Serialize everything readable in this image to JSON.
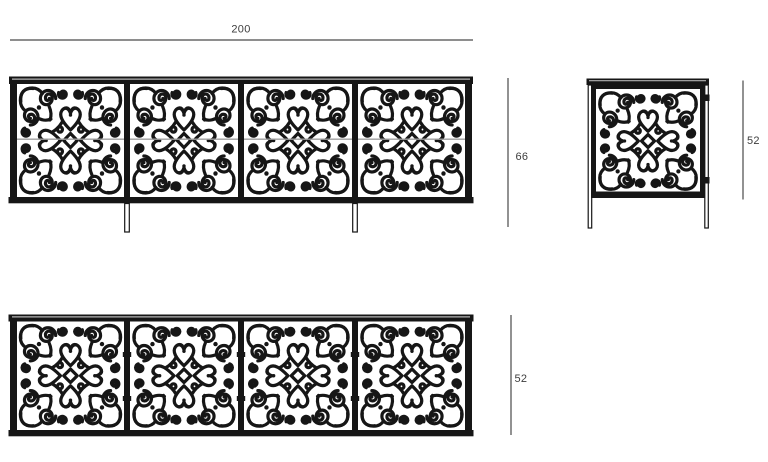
{
  "colors": {
    "bg": "#ffffff",
    "ink": "#161616",
    "dim": "#4a4a4a",
    "label": "#3d3d3d",
    "seam": "#9f9f9f"
  },
  "views": {
    "front": {
      "width_label": "200",
      "height_label": "66"
    },
    "side": {
      "height_label": "52"
    },
    "lower": {
      "height_label": "52"
    }
  }
}
